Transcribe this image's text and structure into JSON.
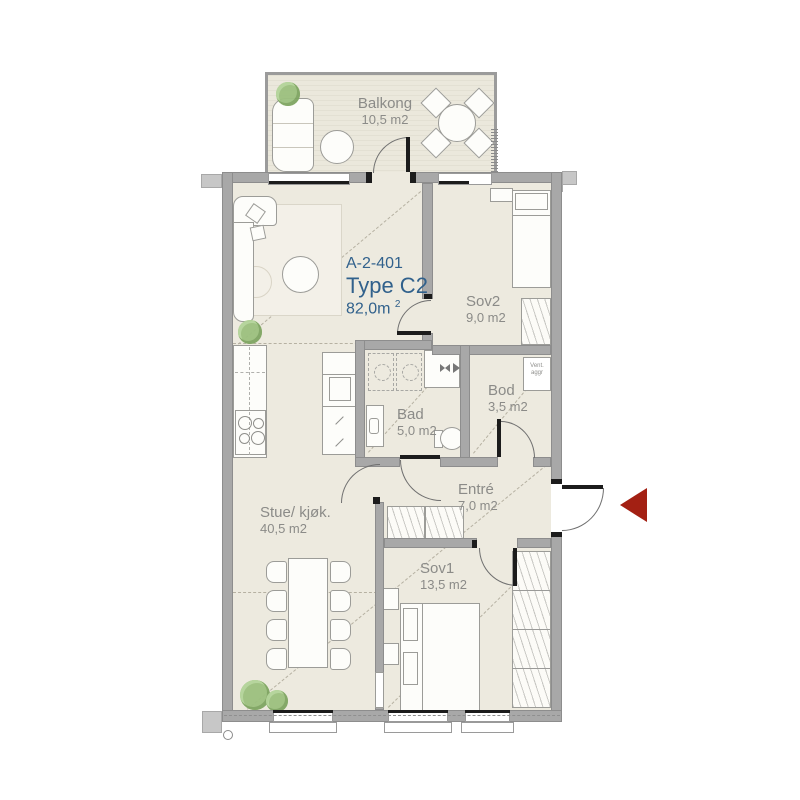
{
  "apartment": {
    "id": "A-2-401",
    "type": "Type C2",
    "area": "82,0m",
    "area_exp": "2"
  },
  "rooms": {
    "balkong": {
      "name": "Balkong",
      "area": "10,5 m2"
    },
    "stue": {
      "name": "Stue/ kjøk.",
      "area": "40,5 m2"
    },
    "sov1": {
      "name": "Sov1",
      "area": "13,5 m2"
    },
    "sov2": {
      "name": "Sov2",
      "area": "9,0 m2"
    },
    "bad": {
      "name": "Bad",
      "area": "5,0 m2"
    },
    "bod": {
      "name": "Bod",
      "area": "3,5 m2"
    },
    "entre": {
      "name": "Entré",
      "area": "7,0 m2"
    }
  },
  "annotations": {
    "vent_unit": "Vent. aggr"
  },
  "colors": {
    "accent_text": "#31618c",
    "label_text": "#8b8b88",
    "entry_arrow": "#a32013",
    "wall": "#a8a8a8",
    "floor": "#edeadf"
  }
}
